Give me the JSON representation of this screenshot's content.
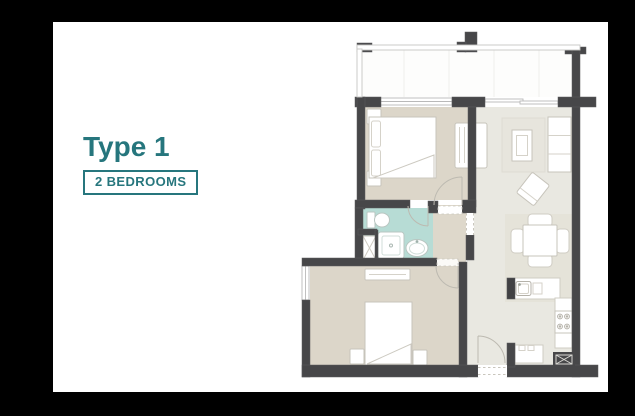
{
  "unit": {
    "title": "Type 1",
    "badge": "2 BEDROOMS"
  },
  "colors": {
    "accent_teal": "#26767d",
    "wall": "#474749",
    "bedroom_floor": "#dcd6c9",
    "living_floor": "#e9e8e1",
    "bathroom_floor": "#b7dcd5",
    "hallway_floor": "#ded8cb",
    "rug": "#e7e5dd",
    "background": "#000000",
    "canvas": "#ffffff"
  },
  "floorplan": {
    "type": "apartment-floor-plan",
    "rooms_depicted": [
      "balcony",
      "bedroom-1",
      "bedroom-2",
      "bathroom",
      "hallway",
      "living-dining",
      "kitchen",
      "entry"
    ]
  }
}
